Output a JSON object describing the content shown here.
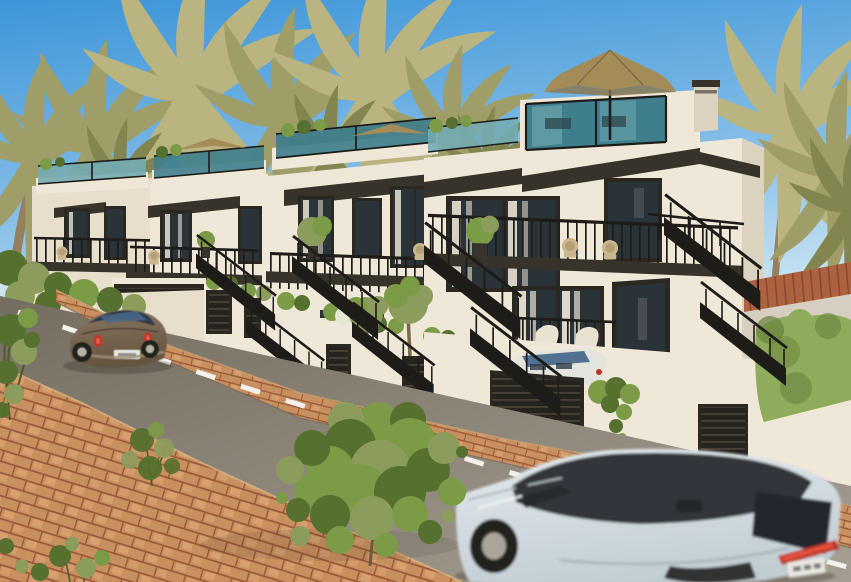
{
  "meta": {
    "type": "architectural exterior render",
    "width": 851,
    "height": 582
  },
  "scene": {
    "label": "New-build white Mediterranean townhouses on a sloping street with palm trees, a parked bronze car and a passing grey SUV",
    "sky": {
      "label": "clear blue sky"
    },
    "background": {
      "hills": "hazy distant hills",
      "palms": "palm canopies behind the roofline",
      "right_palms": "tall palms beside the end house"
    },
    "buildings": {
      "label": "terraced row of four modern townhouses",
      "features": {
        "roof_terrace": "roof terraces with teal glass balustrades and planting",
        "parasol": "khaki patio parasol on the roof terrace",
        "stairs": "black steel exterior staircases",
        "balcony": "black railed balconies with rattan chairs and potted trees",
        "garage": "dark slatted garage doors and gates in white garden walls",
        "entrance": "dark front door with white entry steps",
        "chimney": "rooftop chimney stack",
        "curtains": "white curtains behind glazed doors",
        "planters": "white planters with olive trees and clipped shrubs",
        "ivy": "ivy trailing over a white wall",
        "hedge": "clipped green hedge at the right",
        "tiled_roof": "terracotta tiled roof of the lower neighbouring building"
      }
    },
    "street": {
      "road": "light asphalt road descending to the right",
      "lane_marking": "dashed white centre line",
      "sidewalk": "terracotta brick paver sidewalks"
    },
    "vehicles": {
      "parked_car": "bronze round-back compact car parked at the kerb",
      "suv": "pale grey SUV with black roof driving past, motion blurred",
      "convertible": "white convertible parked in a driveway behind a slatted gate"
    },
    "vegetation": {
      "foreground_tree": "young leafy street tree on the pavement",
      "shrubs": "shrub balls along stepped garden walls",
      "bushes": "loose green bushes on the left verge"
    }
  },
  "colors": {
    "sky_top": "#3D95D8",
    "sky_mid": "#85BEE7",
    "sky_low": "#CFE7F4",
    "sky_horizon": "#EAF2F3",
    "hills": "#93A38D",
    "haze": "#DCE8EA",
    "palm_light": "#B9B480",
    "palm_mid": "#A09E68",
    "palm_dark": "#82854F",
    "palm_trunk": "#94805F",
    "wall_sun": "#EFE8D9",
    "wall_warm": "#E7DECC",
    "wall_shade": "#DBD2C0",
    "ramp_grey": "#D6CEC0",
    "fascia_dark": "#38332A",
    "frame_dark": "#2B2822",
    "glass_dark": "#2A3338",
    "glass_teal": "#3F7E8C",
    "glass_teal_light": "#74ABB3",
    "railing_black": "#1E1C19",
    "umbrella_tan": "#A48C59",
    "umbrella_shadow": "#8C7648",
    "curtain_cream": "#E9E2D2",
    "chair_wicker": "#CBB68D",
    "plant_green": "#7C9B46",
    "plant_dark": "#55702F",
    "olive_green": "#8C9C5C",
    "hedge_green": "#8FAC5C",
    "hedge_dark": "#66823C",
    "roof_tile": "#AF6240",
    "roof_tile_dark": "#8A4830",
    "slat_dark": "#26231E",
    "slat_light": "#4C4538",
    "road_light": "#A39C90",
    "road_dark": "#746D60",
    "lane_white": "#F2F1EC",
    "brick_base": "#C9905F",
    "brick_line": "#9A583A",
    "brick_light": "#E2AC79",
    "beetle_body": "#8A7763",
    "beetle_shade": "#64543F",
    "beetle_window": "#2E3A46",
    "beetle_glass_blue": "#4A6A8C",
    "taillight_red": "#C03227",
    "suv_body": "#E3EAEE",
    "suv_body_shade": "#C2CDD3",
    "suv_roof": "#33363A",
    "suv_window": "#23282E",
    "wheel_dark": "#23211E",
    "rim_silver": "#B9B4A8",
    "plate_white": "#E9E9E2",
    "shadow_dark": "#3A352C"
  }
}
